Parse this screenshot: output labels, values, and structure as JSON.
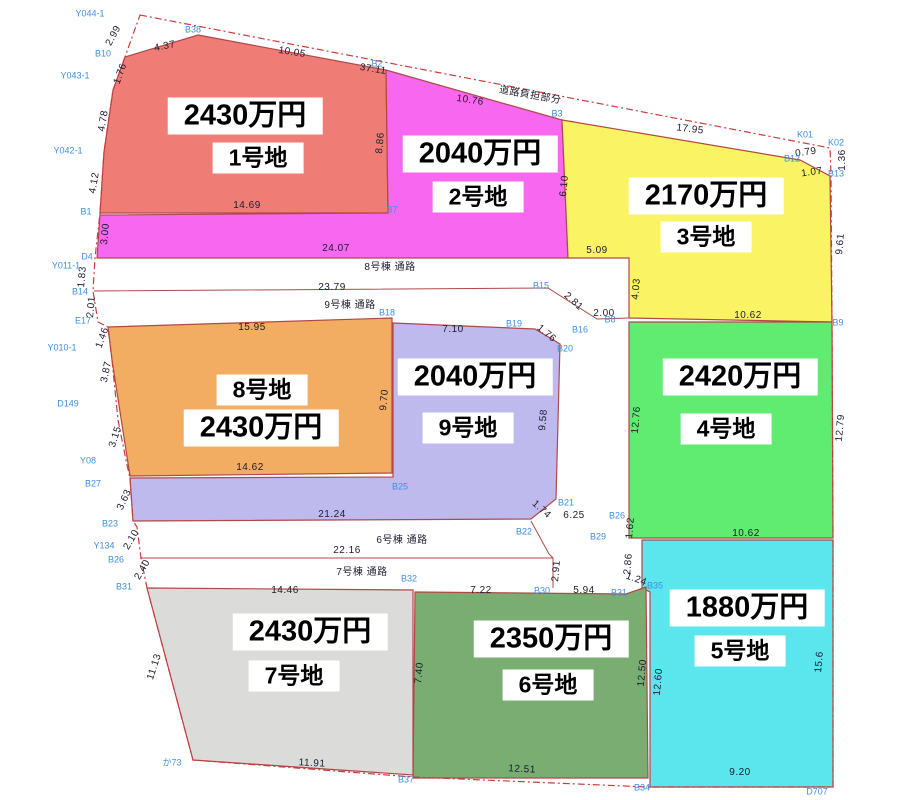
{
  "canvas": {
    "width": 923,
    "height": 800,
    "background": "#ffffff",
    "plot_stroke": "#b04848",
    "boundary_stroke": "#cc3b3b",
    "point_label_color": "#3f8fdf",
    "dimension_color": "#1c1c2e"
  },
  "plots": [
    {
      "id": "plot-1",
      "name": "1号地",
      "price": "2430万円",
      "color": "#ef7d75",
      "points": "198,35 386,70 388,213 100,213 104,152 113,90 125,57",
      "price_pos": [
        245,
        116
      ],
      "name_pos": [
        258,
        158
      ]
    },
    {
      "id": "plot-2",
      "name": "2号地",
      "price": "2040万円",
      "color": "#f767ef",
      "points": "386,70 562,120 568,258 97,258 100,215 388,213",
      "price_pos": [
        480,
        154
      ],
      "name_pos": [
        478,
        197
      ]
    },
    {
      "id": "plot-3",
      "name": "3号地",
      "price": "2170万円",
      "color": "#faf464",
      "points": "562,120 800,160 830,176 832,322 629,318 629,258 568,258",
      "price_pos": [
        706,
        196
      ],
      "name_pos": [
        706,
        237
      ]
    },
    {
      "id": "plot-4",
      "name": "4号地",
      "price": "2420万円",
      "color": "#5fec70",
      "points": "629,322 832,322 833,538 629,538",
      "price_pos": [
        740,
        377
      ],
      "name_pos": [
        726,
        429
      ]
    },
    {
      "id": "plot-5",
      "name": "5号地",
      "price": "1880万円",
      "color": "#5be6ed",
      "points": "642,540 833,540 833,787 650,787 650,592 642,588",
      "price_pos": [
        747,
        608
      ],
      "name_pos": [
        740,
        651
      ]
    },
    {
      "id": "plot-6",
      "name": "6号地",
      "price": "2350万円",
      "color": "#7aad72",
      "points": "415,592 626,594 646,587 648,778 413,778",
      "price_pos": [
        551,
        639
      ],
      "name_pos": [
        548,
        685
      ]
    },
    {
      "id": "plot-7",
      "name": "7号地",
      "price": "2430万円",
      "color": "#dbdbd9",
      "points": "147,588 413,590 413,775 193,760",
      "price_pos": [
        310,
        632
      ],
      "name_pos": [
        294,
        676
      ]
    },
    {
      "id": "plot-8",
      "name": "8号地",
      "price": "2430万円",
      "color": "#f3ad62",
      "points": "108,327 392,318 392,473 130,476 112,360",
      "price_pos": [
        261,
        428
      ],
      "name_pos": [
        262,
        390
      ]
    },
    {
      "id": "plot-9",
      "name": "9号地",
      "price": "2040万円",
      "color": "#bfbaee",
      "points": "393,323 535,329 560,344 556,499 531,519 133,521 130,478 393,477",
      "price_pos": [
        475,
        377
      ],
      "name_pos": [
        468,
        428
      ]
    }
  ],
  "boundary": {
    "points": "140,15 830,148 831,176 832,322 833,538 833,787 648,787 413,777 193,760 147,588 141,558 137,527 133,521 130,478 127,465 118,420 112,360 108,327 98,322 93,291 95,258 100,213 104,152 113,90 125,57"
  },
  "road_lines": [
    {
      "name": "road-separator-upper",
      "points": "94,291 548,288 597,319 629,318"
    },
    {
      "name": "road-separator-lower",
      "points": "140,558 553,558"
    },
    {
      "name": "road-edge-right-lower",
      "points": "531,521 549,554 553,558 553,588"
    }
  ],
  "dimensions": [
    {
      "text": "2.99",
      "x": 114,
      "y": 36,
      "rot": -62
    },
    {
      "text": "4.37",
      "x": 165,
      "y": 47,
      "rot": -12
    },
    {
      "text": "10.05",
      "x": 292,
      "y": 53,
      "rot": 9
    },
    {
      "text": "37.11",
      "x": 373,
      "y": 70,
      "rot": 9
    },
    {
      "text": "道路負担部分",
      "x": 530,
      "y": 96,
      "rot": 10
    },
    {
      "text": "10.76",
      "x": 470,
      "y": 101,
      "rot": 9
    },
    {
      "text": "17.95",
      "x": 690,
      "y": 130,
      "rot": 7
    },
    {
      "text": "1.76",
      "x": 121,
      "y": 74,
      "rot": -70
    },
    {
      "text": "4.78",
      "x": 104,
      "y": 121,
      "rot": -80
    },
    {
      "text": "4.12",
      "x": 95,
      "y": 183,
      "rot": -80
    },
    {
      "text": "8.86",
      "x": 381,
      "y": 143,
      "rot": -85
    },
    {
      "text": "14.69",
      "x": 247,
      "y": 206,
      "rot": 0
    },
    {
      "text": "3.00",
      "x": 106,
      "y": 234,
      "rot": -85
    },
    {
      "text": "24.07",
      "x": 336,
      "y": 249,
      "rot": 0
    },
    {
      "text": "0.79",
      "x": 806,
      "y": 153,
      "rot": -8
    },
    {
      "text": "1.07",
      "x": 812,
      "y": 173,
      "rot": -8
    },
    {
      "text": "1.36",
      "x": 843,
      "y": 160,
      "rot": -90
    },
    {
      "text": "6.10",
      "x": 565,
      "y": 186,
      "rot": -85
    },
    {
      "text": "5.09",
      "x": 597,
      "y": 251,
      "rot": 0
    },
    {
      "text": "4.03",
      "x": 637,
      "y": 289,
      "rot": -85
    },
    {
      "text": "9.61",
      "x": 841,
      "y": 244,
      "rot": -85
    },
    {
      "text": "10.62",
      "x": 748,
      "y": 316,
      "rot": 0
    },
    {
      "text": "8号棟 通路",
      "x": 390,
      "y": 268,
      "rot": 0
    },
    {
      "text": "23.79",
      "x": 332,
      "y": 288,
      "rot": 0
    },
    {
      "text": "9号棟 通路",
      "x": 350,
      "y": 306,
      "rot": 0
    },
    {
      "text": "2.81",
      "x": 573,
      "y": 302,
      "rot": 42
    },
    {
      "text": "2.00",
      "x": 604,
      "y": 314,
      "rot": 0
    },
    {
      "text": "1.83",
      "x": 83,
      "y": 277,
      "rot": -85
    },
    {
      "text": "2.01",
      "x": 92,
      "y": 307,
      "rot": -85
    },
    {
      "text": "1.46",
      "x": 103,
      "y": 338,
      "rot": -70
    },
    {
      "text": "3.87",
      "x": 107,
      "y": 372,
      "rot": -78
    },
    {
      "text": "3.15",
      "x": 116,
      "y": 437,
      "rot": -72
    },
    {
      "text": "3.63",
      "x": 125,
      "y": 500,
      "rot": -65
    },
    {
      "text": "2.10",
      "x": 132,
      "y": 540,
      "rot": -60
    },
    {
      "text": "2.40",
      "x": 143,
      "y": 570,
      "rot": -60
    },
    {
      "text": "15.95",
      "x": 252,
      "y": 328,
      "rot": 0
    },
    {
      "text": "7.10",
      "x": 453,
      "y": 330,
      "rot": 0
    },
    {
      "text": "1.76",
      "x": 546,
      "y": 334,
      "rot": 40
    },
    {
      "text": "9.70",
      "x": 385,
      "y": 400,
      "rot": -85
    },
    {
      "text": "9.58",
      "x": 544,
      "y": 420,
      "rot": -85
    },
    {
      "text": "12.76",
      "x": 637,
      "y": 420,
      "rot": -85
    },
    {
      "text": "12.79",
      "x": 841,
      "y": 428,
      "rot": -85
    },
    {
      "text": "14.62",
      "x": 250,
      "y": 468,
      "rot": 0
    },
    {
      "text": "21.24",
      "x": 332,
      "y": 515,
      "rot": 0
    },
    {
      "text": "1.74",
      "x": 541,
      "y": 510,
      "rot": 42
    },
    {
      "text": "6.25",
      "x": 574,
      "y": 516,
      "rot": 0
    },
    {
      "text": "1.62",
      "x": 631,
      "y": 528,
      "rot": -85
    },
    {
      "text": "10.62",
      "x": 746,
      "y": 534,
      "rot": 0
    },
    {
      "text": "6号棟 通路",
      "x": 402,
      "y": 541,
      "rot": 0
    },
    {
      "text": "22.16",
      "x": 347,
      "y": 551,
      "rot": 0
    },
    {
      "text": "7号棟 通路",
      "x": 362,
      "y": 573,
      "rot": 0
    },
    {
      "text": "2.91",
      "x": 557,
      "y": 571,
      "rot": -85
    },
    {
      "text": "14.46",
      "x": 285,
      "y": 591,
      "rot": 0
    },
    {
      "text": "7.22",
      "x": 481,
      "y": 591,
      "rot": 0
    },
    {
      "text": "5.94",
      "x": 584,
      "y": 591,
      "rot": 0
    },
    {
      "text": "1.24",
      "x": 636,
      "y": 580,
      "rot": 20
    },
    {
      "text": "2.86",
      "x": 629,
      "y": 564,
      "rot": -85
    },
    {
      "text": "11.13",
      "x": 155,
      "y": 667,
      "rot": -72
    },
    {
      "text": "7.40",
      "x": 420,
      "y": 673,
      "rot": -85
    },
    {
      "text": "12.50",
      "x": 643,
      "y": 673,
      "rot": -85
    },
    {
      "text": "12.60",
      "x": 659,
      "y": 682,
      "rot": -85
    },
    {
      "text": "15.6",
      "x": 820,
      "y": 662,
      "rot": -85
    },
    {
      "text": "11.91",
      "x": 312,
      "y": 764,
      "rot": 3
    },
    {
      "text": "12.51",
      "x": 522,
      "y": 770,
      "rot": 3
    },
    {
      "text": "9.20",
      "x": 740,
      "y": 773,
      "rot": 0
    }
  ],
  "points": [
    {
      "text": "Y044-1",
      "x": 90,
      "y": 14
    },
    {
      "text": "B38",
      "x": 193,
      "y": 30
    },
    {
      "text": "B10",
      "x": 103,
      "y": 54
    },
    {
      "text": "Y043-1",
      "x": 75,
      "y": 76
    },
    {
      "text": "Y042-1",
      "x": 68,
      "y": 151
    },
    {
      "text": "B1",
      "x": 86,
      "y": 212
    },
    {
      "text": "B2",
      "x": 377,
      "y": 64
    },
    {
      "text": "B7",
      "x": 392,
      "y": 210
    },
    {
      "text": "B3",
      "x": 557,
      "y": 114
    },
    {
      "text": "K01",
      "x": 805,
      "y": 135
    },
    {
      "text": "K02",
      "x": 836,
      "y": 143
    },
    {
      "text": "B12",
      "x": 792,
      "y": 159
    },
    {
      "text": "B13",
      "x": 836,
      "y": 174
    },
    {
      "text": "B8",
      "x": 610,
      "y": 320
    },
    {
      "text": "B9",
      "x": 838,
      "y": 323
    },
    {
      "text": "D4",
      "x": 87,
      "y": 257
    },
    {
      "text": "Y011-1",
      "x": 66,
      "y": 266
    },
    {
      "text": "B14",
      "x": 80,
      "y": 292
    },
    {
      "text": "E17",
      "x": 83,
      "y": 321
    },
    {
      "text": "Y010-1",
      "x": 62,
      "y": 348
    },
    {
      "text": "D149",
      "x": 68,
      "y": 404
    },
    {
      "text": "Y08",
      "x": 88,
      "y": 461
    },
    {
      "text": "B27",
      "x": 93,
      "y": 484
    },
    {
      "text": "B18",
      "x": 387,
      "y": 313
    },
    {
      "text": "B19",
      "x": 514,
      "y": 324
    },
    {
      "text": "B15",
      "x": 541,
      "y": 286
    },
    {
      "text": "B16",
      "x": 580,
      "y": 330
    },
    {
      "text": "B20",
      "x": 565,
      "y": 349
    },
    {
      "text": "B25",
      "x": 400,
      "y": 487
    },
    {
      "text": "B21",
      "x": 566,
      "y": 503
    },
    {
      "text": "B22",
      "x": 524,
      "y": 532
    },
    {
      "text": "B26",
      "x": 617,
      "y": 516
    },
    {
      "text": "B29",
      "x": 598,
      "y": 537
    },
    {
      "text": "B23",
      "x": 110,
      "y": 524
    },
    {
      "text": "Y134",
      "x": 104,
      "y": 546
    },
    {
      "text": "B26",
      "x": 116,
      "y": 560
    },
    {
      "text": "B31",
      "x": 124,
      "y": 587
    },
    {
      "text": "B32",
      "x": 409,
      "y": 579
    },
    {
      "text": "B30",
      "x": 542,
      "y": 591
    },
    {
      "text": "B31",
      "x": 619,
      "y": 593
    },
    {
      "text": "B35",
      "x": 655,
      "y": 586
    },
    {
      "text": "B37",
      "x": 406,
      "y": 780
    },
    {
      "text": "B34",
      "x": 642,
      "y": 788
    },
    {
      "text": "D707",
      "x": 817,
      "y": 792
    },
    {
      "text": "か73",
      "x": 172,
      "y": 763
    }
  ]
}
